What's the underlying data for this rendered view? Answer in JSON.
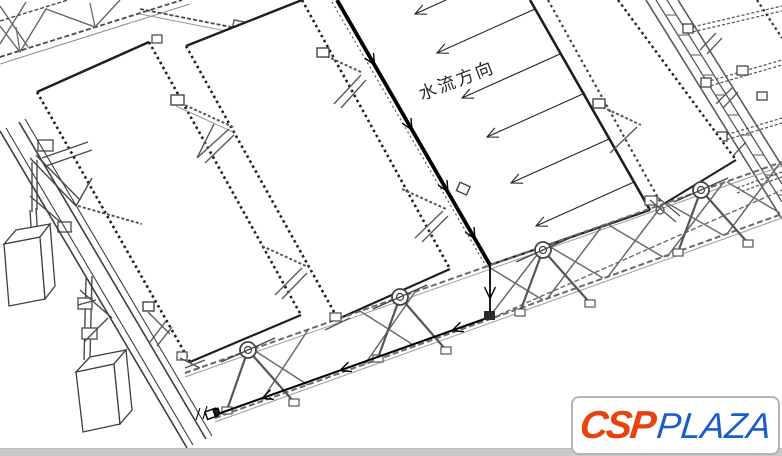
{
  "annotation": {
    "flow_direction_label": "水流方向"
  },
  "logo": {
    "csp": "CSP",
    "plaza": "PLAZA",
    "csp_color": "#e8430f",
    "plaza_color": "#1b5ec9",
    "border_color": "#b4b4b4"
  },
  "colors": {
    "background": "#ffffff",
    "drawing_dark": "#1f1f1f",
    "drawing_medium": "#555555",
    "drawing_light": "#8c8c8c",
    "flow_ink": "#000000",
    "bottom_band": "#c9c9c9"
  }
}
